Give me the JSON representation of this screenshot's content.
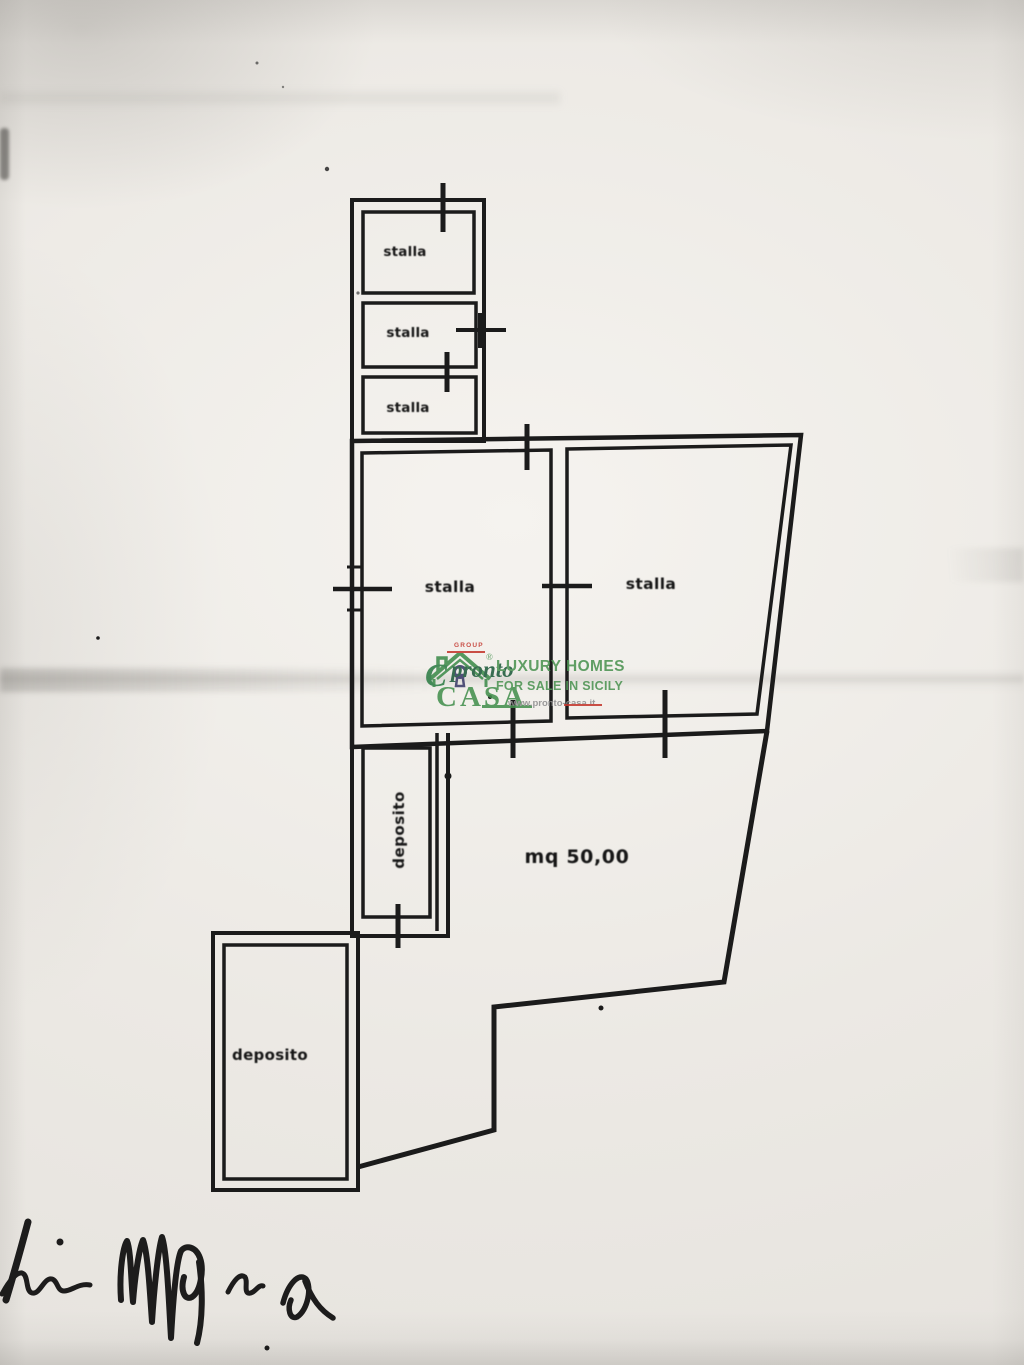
{
  "labels": {
    "stalla_small_1": "stalla",
    "stalla_small_2": "stalla",
    "stalla_small_3": "stalla",
    "stalla_main_left": "stalla",
    "stalla_main_right": "stalla",
    "deposito_upper": "deposito",
    "deposito_lower": "deposito",
    "area_size": "mq 50,00"
  },
  "watermark": {
    "group": "GROUP",
    "registered": "®",
    "brand_script": "pronto",
    "brand_caps": "CASA",
    "tagline_1": "LUXURY HOMES",
    "tagline_2": "FOR SALE IN SICILY",
    "website": "www.pronto-casa.it"
  },
  "colors": {
    "ink": "#1b1b1b",
    "signature_ink": "#0d0d0d",
    "paper": "#ece9e4",
    "logo_green": "#45904e",
    "logo_dark_green": "#1f5c3d",
    "logo_red": "#c4382f",
    "logo_gray": "#8f8f8f",
    "keyhole_navy": "#3c3c6a"
  }
}
